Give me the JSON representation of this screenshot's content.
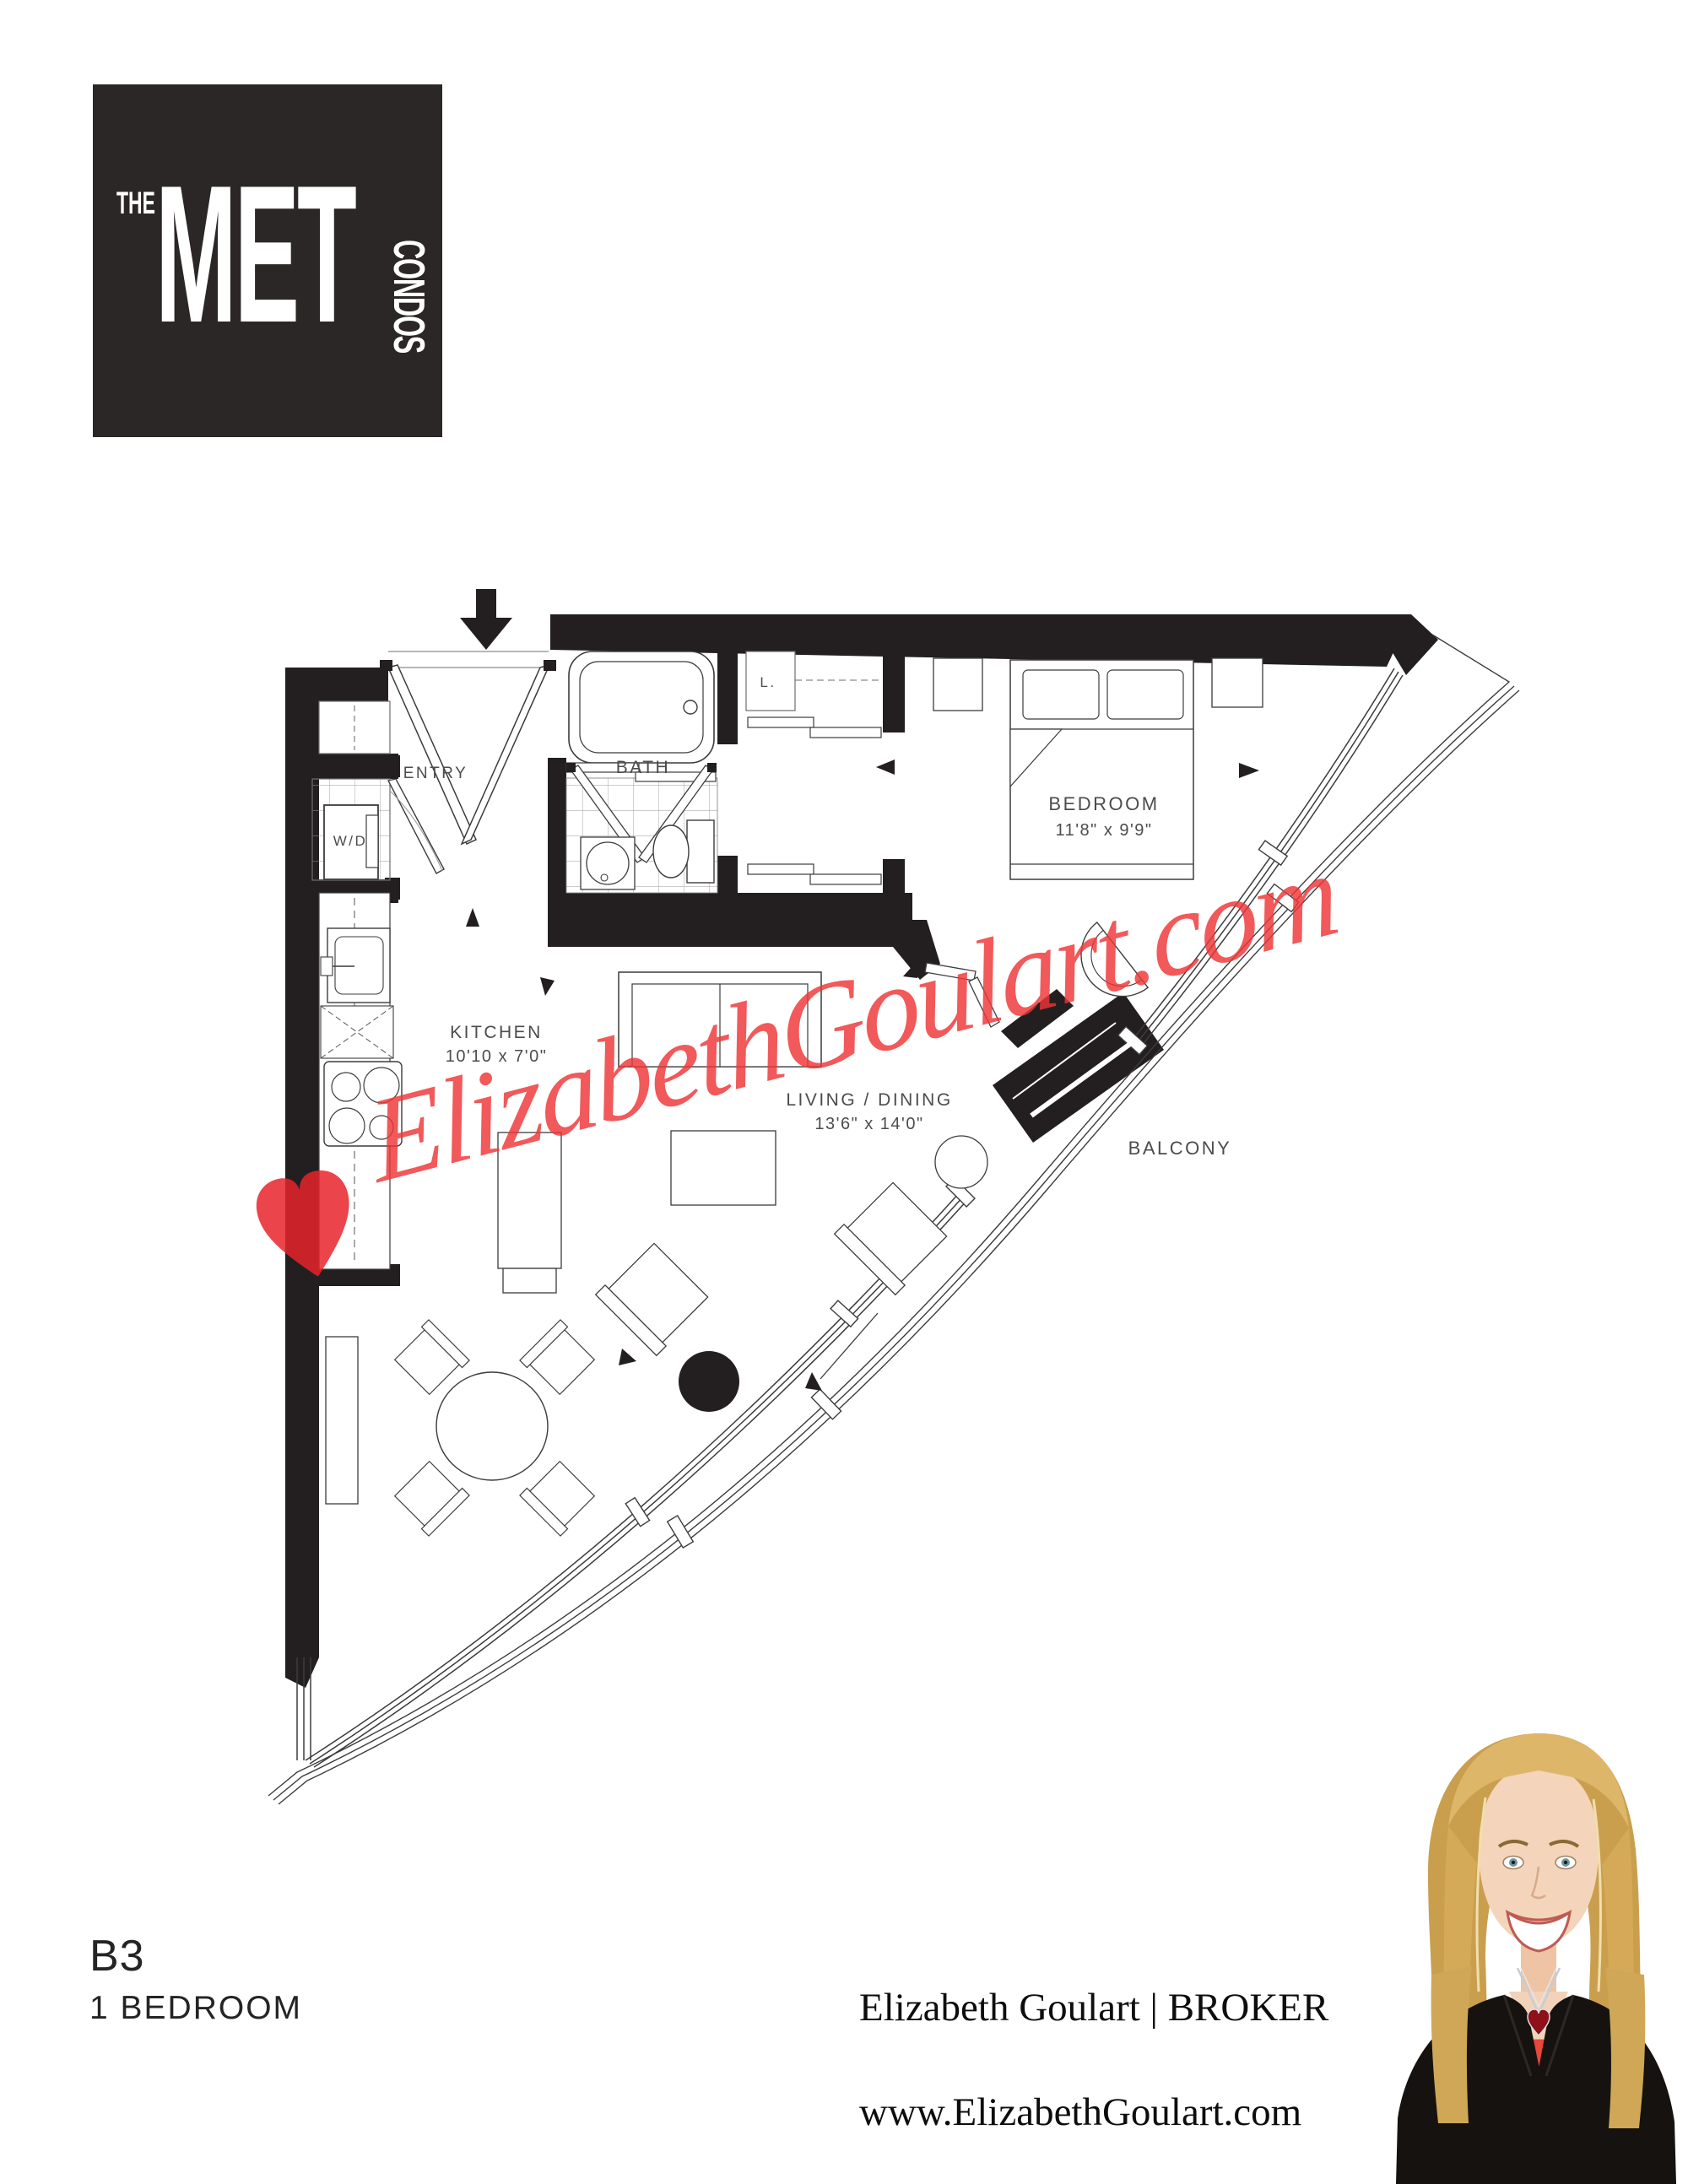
{
  "logo": {
    "the": "THE",
    "met": "MET",
    "condos": "CONDOS"
  },
  "plan": {
    "labels": {
      "entry": "ENTRY",
      "wd": "W/D",
      "bath": "BATH",
      "linen": "L.",
      "bedroom": "BEDROOM",
      "bedroom_dims": "11'8\" x 9'9\"",
      "kitchen": "KITCHEN",
      "kitchen_dims": "10'10 x 7'0\"",
      "living": "LIVING / DINING",
      "living_dims": "13'6\" x 14'0\"",
      "balcony": "BALCONY"
    },
    "icons": {
      "entry_arrow": "down-arrow",
      "door_arrows": "triangle-pointer"
    },
    "colors": {
      "wall": "#231f20",
      "line": "#3c3c3c",
      "label": "#4c4c4c",
      "tile": "#9a9a9a"
    }
  },
  "watermark": {
    "text": "ElizabethGoulart.com",
    "color": "#ee3436",
    "heart_color": "#e8232b"
  },
  "footer": {
    "unit_code": "B3",
    "unit_type": "1 BEDROOM",
    "broker": "Elizabeth Goulart | BROKER",
    "website": "www.ElizabethGoulart.com"
  }
}
